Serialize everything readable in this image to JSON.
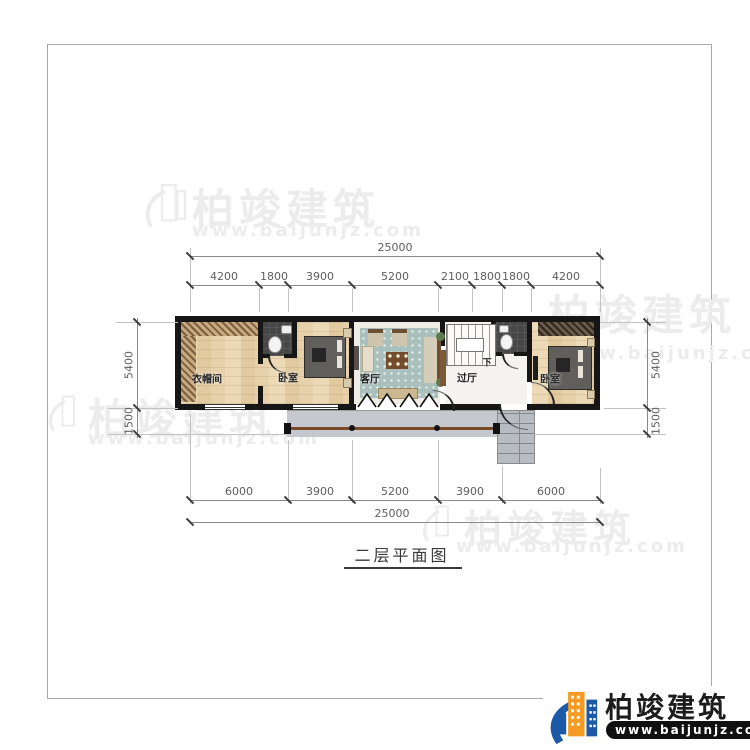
{
  "title": {
    "text": "二层平面图"
  },
  "brand": {
    "name": "柏竣建筑",
    "url": "www.baijunjz.com"
  },
  "plan": {
    "rooms": {
      "cloakroom": "衣帽间",
      "bedroom_left": "卧室",
      "living_room": "客厅",
      "hall": "过厅",
      "bedroom_right": "卧室"
    },
    "stair_direction": "下"
  },
  "dimensions": {
    "top_total": "25000",
    "top_segments": [
      "4200",
      "1800",
      "3900",
      "5200",
      "2100",
      "1800",
      "1800",
      "4200"
    ],
    "left": [
      "5400",
      "1500"
    ],
    "right": [
      "5400",
      "1500"
    ],
    "bottom_segments": [
      "6000",
      "3900",
      "5200",
      "3900",
      "6000"
    ],
    "bottom_total": "25000"
  },
  "colors": {
    "wall": "#161616",
    "balcony_rail": "#7a4a28",
    "logo_blue": "#1c59a6",
    "logo_orange": "#f59a23",
    "watermark": "#ececec"
  }
}
